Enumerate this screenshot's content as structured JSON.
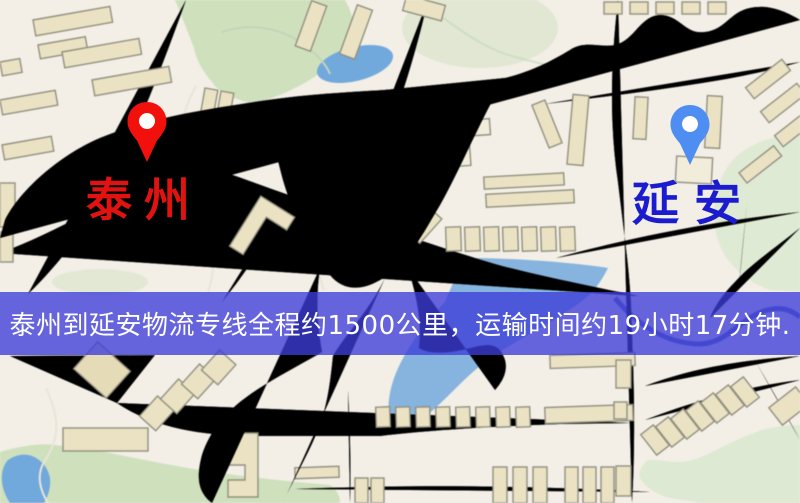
{
  "origin": {
    "name": "泰州",
    "pin_icon": "map-pin-icon"
  },
  "destination": {
    "name": "延安",
    "pin_icon": "map-pin-icon"
  },
  "banner": {
    "text": "泰州到延安物流专线全程约1500公里，运输时间约19小时17分钟."
  },
  "theme": {
    "bg": "#f3efe7",
    "road": "#f7d87b",
    "road_edge": "#e9bf62",
    "park": "#cfe0bd",
    "water": "#72a9dc",
    "building": "#ebe2c4",
    "building_edge": "#91907f",
    "rail": "#26262a",
    "banner_bg": "rgba(60,60,216,0.78)",
    "banner_text": "#ffffff",
    "pin_origin": "#f2100c",
    "pin_dest": "#4e8ef2",
    "label_origin": "#e01310",
    "label_dest": "#1c1ccf"
  }
}
